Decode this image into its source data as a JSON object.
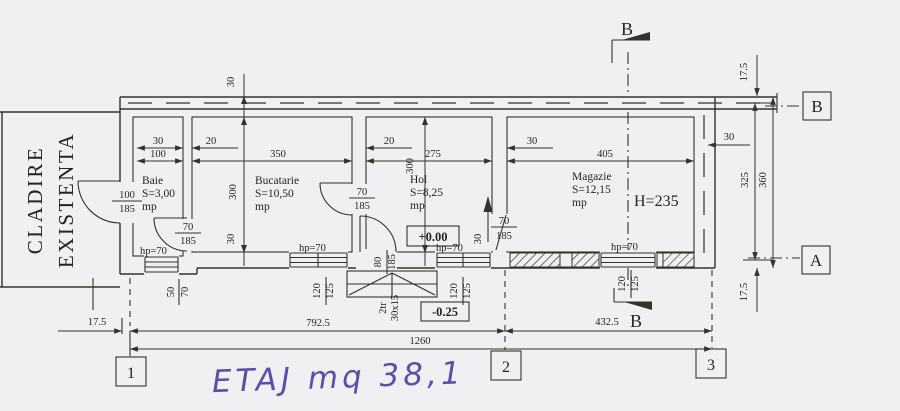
{
  "colors": {
    "paper": "#eff0f2",
    "ink": "#34322d",
    "handwriting": "#5b4fa5"
  },
  "existing_building": {
    "line1": "CLADIRE",
    "line2": "EXISTENTA"
  },
  "rooms": {
    "baie": {
      "name": "Baie",
      "area": "S=3,00",
      "unit": "mp"
    },
    "bucatarie": {
      "name": "Bucatarie",
      "area": "S=10,50",
      "unit": "mp"
    },
    "hol": {
      "name": "Hol",
      "area": "S=8,25",
      "unit": "mp"
    },
    "magazie": {
      "name": "Magazie",
      "area": "S=12,15",
      "unit": "mp",
      "height": "H=235"
    }
  },
  "levels": {
    "interior": "+0.00",
    "exterior": "-0.25"
  },
  "stairs": {
    "count": "2tr",
    "size": "30x15"
  },
  "doors": {
    "cladire_w": "100",
    "cladire_h": "185",
    "baie_w": "70",
    "baie_h": "185",
    "bucatarie_w": "70",
    "bucatarie_h": "185",
    "magazie_w": "70",
    "magazie_h": "185",
    "entry_w": "80",
    "entry_h": "185"
  },
  "windows": {
    "hp": "hp=70",
    "baie_w": "50",
    "baie_h": "70",
    "bucatarie_w": "120",
    "bucatarie_h": "125",
    "hol_w": "120",
    "hol_h": "125",
    "magazie_w": "120",
    "magazie_h": "125"
  },
  "dims": {
    "baie_wall": "30",
    "baie_width": "100",
    "p1": "20",
    "bucatarie_width": "350",
    "p2": "20",
    "hol_width": "275",
    "p3": "30",
    "magazie_width": "405",
    "right_wall": "30",
    "top_wall": "30",
    "bucatarie_depth": "300",
    "bucatarie_sill": "30",
    "hol_depth": "300",
    "hol_sill": "30",
    "parapet_top": "17.5",
    "depth_inner": "325",
    "depth_outer": "360",
    "parapet_bottom": "17.5",
    "axis_offset": "17.5",
    "span_1_2": "792.5",
    "span_2_3": "432.5",
    "span_total": "1260"
  },
  "axes": {
    "a1": "1",
    "a2": "2",
    "a3": "3"
  },
  "sections": {
    "b_top": "B",
    "b_bottom": "B",
    "marker_b": "B",
    "marker_a": "A"
  },
  "annotation": {
    "text": "ETAJ mq 38,1"
  }
}
